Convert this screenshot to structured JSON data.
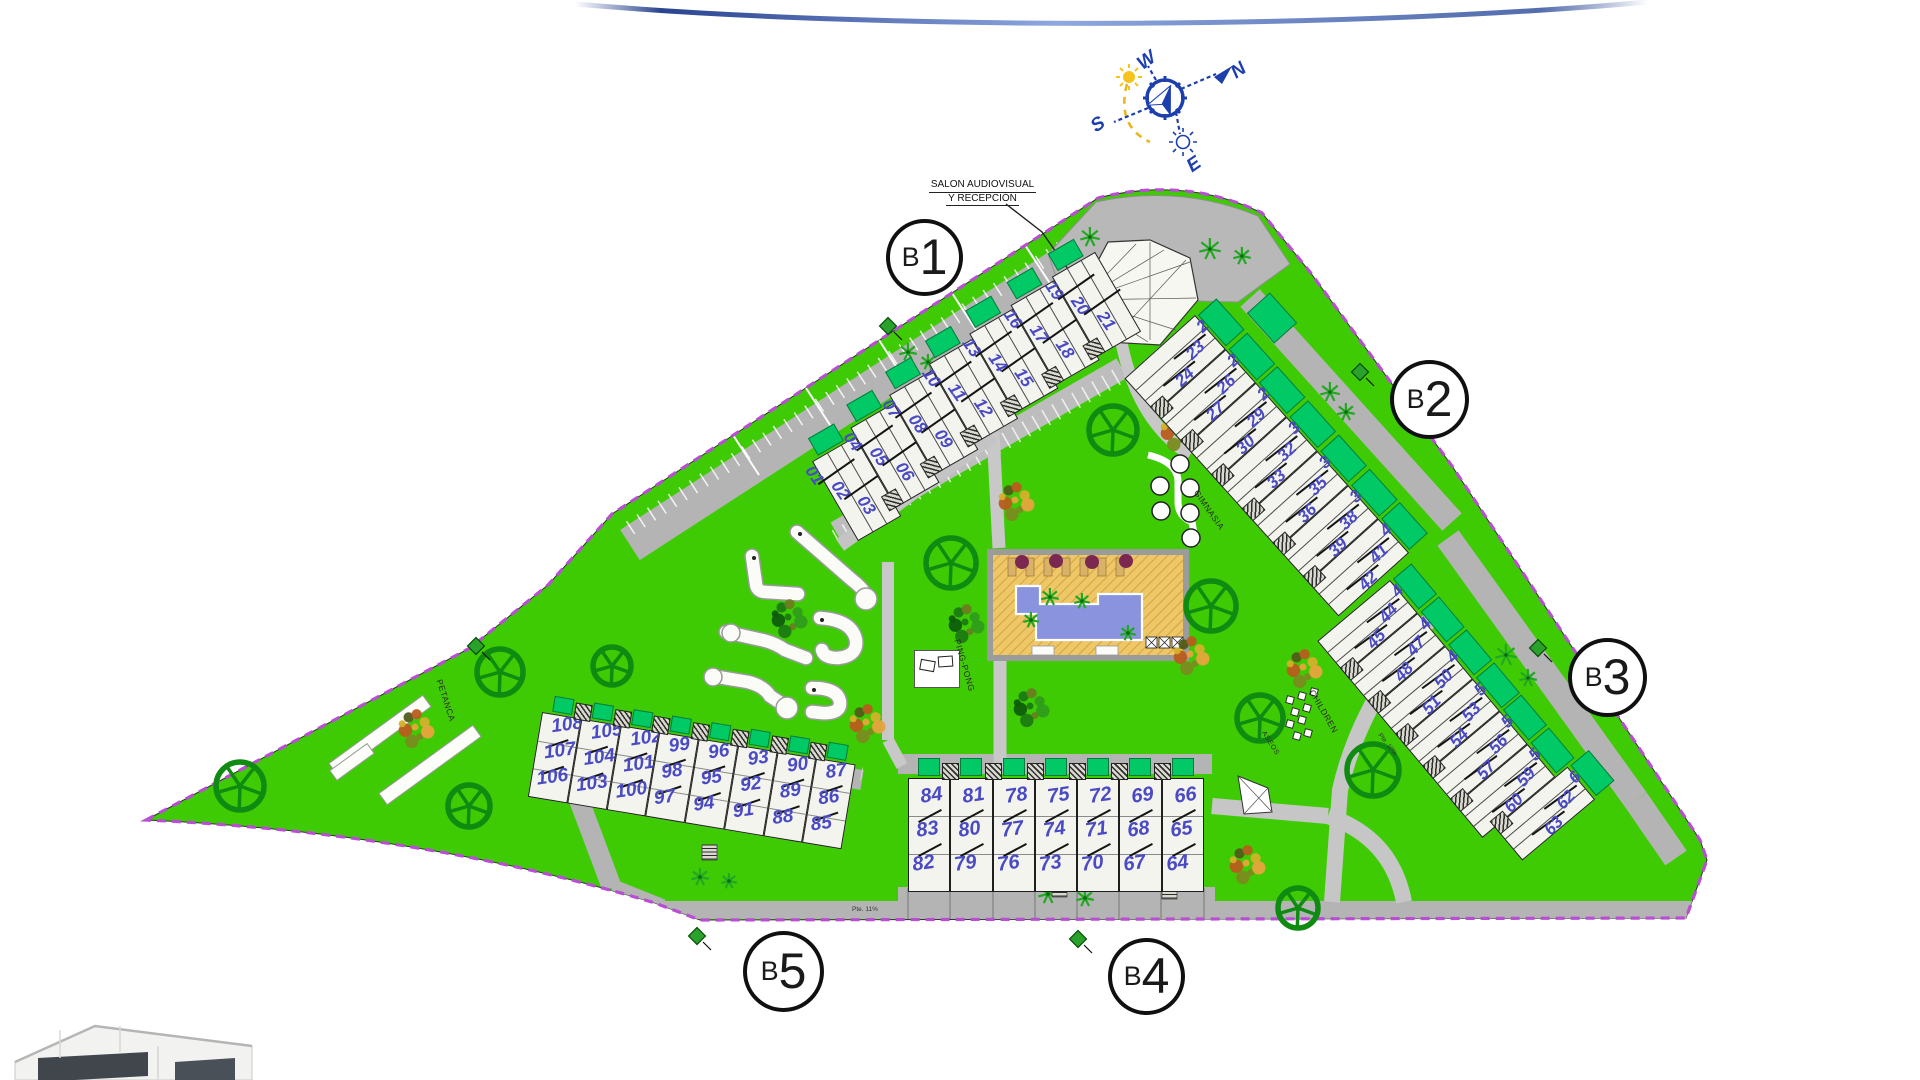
{
  "site_plan": {
    "compass": {
      "north": "N",
      "south": "S",
      "east": "E",
      "west": "W"
    },
    "callout": {
      "line1": "SALON AUDIOVISUAL",
      "line2": "Y RECEPCIÓN"
    },
    "area_labels": {
      "petanca": "PETANCA",
      "ping_pong": "PING-PONG",
      "gimnasia": "GIMNASIA",
      "children": "CHILDREN",
      "aseos": "ASEOS"
    },
    "road_labels": [
      "Pte. 11%",
      "Pte. 10%"
    ],
    "buildings": [
      {
        "id": "B1",
        "circle": "B1",
        "groups": [
          [
            "01",
            "02",
            "03"
          ],
          [
            "04",
            "05",
            "06"
          ],
          [
            "07",
            "08",
            "09"
          ],
          [
            "10",
            "11",
            "12"
          ],
          [
            "13",
            "14",
            "15"
          ],
          [
            "16",
            "17",
            "18"
          ],
          [
            "19",
            "20",
            "21"
          ]
        ]
      },
      {
        "id": "B2",
        "circle": "B2",
        "groups": [
          [
            "22",
            "23",
            "24"
          ],
          [
            "25",
            "26",
            "27"
          ],
          [
            "28",
            "29",
            "30"
          ],
          [
            "31",
            "32",
            "33"
          ],
          [
            "34",
            "35",
            "36"
          ],
          [
            "37",
            "38",
            "39"
          ],
          [
            "40",
            "41",
            "42"
          ]
        ]
      },
      {
        "id": "B3",
        "circle": "B3",
        "groups": [
          [
            "43",
            "44",
            "45"
          ],
          [
            "46",
            "47",
            "48"
          ],
          [
            "49",
            "50",
            "51"
          ],
          [
            "52",
            "53",
            "54"
          ],
          [
            "55",
            "56",
            "57"
          ],
          [
            "58",
            "59",
            "60"
          ],
          [
            "61",
            "62",
            "63"
          ]
        ]
      },
      {
        "id": "B4",
        "circle": "B4",
        "groups": [
          [
            "84",
            "83",
            "82"
          ],
          [
            "81",
            "80",
            "79"
          ],
          [
            "78",
            "77",
            "76"
          ],
          [
            "75",
            "74",
            "73"
          ],
          [
            "72",
            "71",
            "70"
          ],
          [
            "69",
            "68",
            "67"
          ],
          [
            "66",
            "65",
            "64"
          ]
        ]
      },
      {
        "id": "B5",
        "circle": "B5",
        "groups": [
          [
            "108",
            "107",
            "106"
          ],
          [
            "105",
            "104",
            "103"
          ],
          [
            "102",
            "101",
            "100"
          ],
          [
            "99",
            "98",
            "97"
          ],
          [
            "96",
            "95",
            "94"
          ],
          [
            "93",
            "92",
            "91"
          ],
          [
            "90",
            "89",
            "88"
          ],
          [
            "87",
            "86",
            "85"
          ]
        ]
      }
    ],
    "colors": {
      "grass": "#3ecb04",
      "terrace_green": "#00c965",
      "road": "#b3b3b3",
      "building_fill": "#f4f4ee",
      "unit_number": "#4a4ac4",
      "boundary": "#b84fd2",
      "pool_water": "#8a93de",
      "pool_deck": "#eec768",
      "tree_green": "#0e8b10",
      "palm_green": "#23a823",
      "compass_blue": "#1d3fae",
      "sun_yellow": "#f5c41d"
    }
  }
}
